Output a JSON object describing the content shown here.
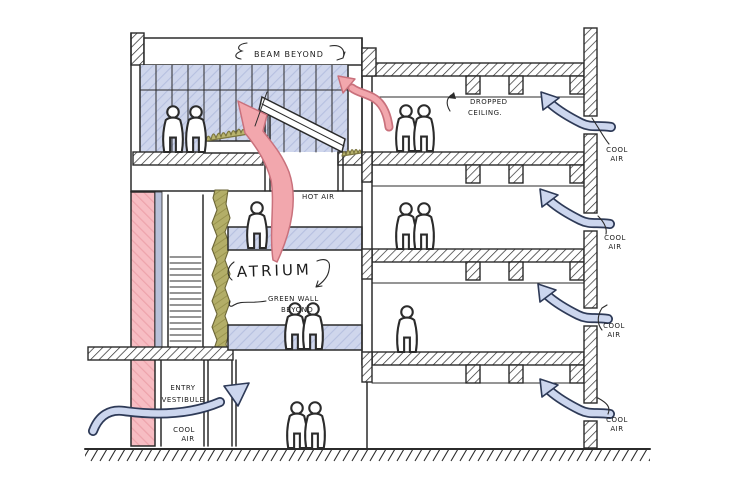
{
  "diagram": {
    "kind": "hand-drawn architectural building section with airflow annotations"
  },
  "labels": {
    "beam_beyond": "BEAM BEYOND",
    "dropped_ceiling": [
      "DROPPED",
      "CEILING."
    ],
    "hot_air": "HOT AIR",
    "atrium": "ATRIUM",
    "green_wall": [
      "GREEN WALL",
      "BEYOND"
    ],
    "entry_vestibule": [
      "ENTRY",
      "VESTIBULE"
    ],
    "cool_air": [
      "COOL",
      "AIR"
    ]
  },
  "colors": {
    "hot_air_arrow": "#f2a7ad",
    "hot_air_outline": "#c9717c",
    "cool_air_arrow": "#ccd6ee",
    "cool_air_outline": "#2e3a57",
    "glazing_blue": "#cfd6ec",
    "structure_pink": "#f7bdc3",
    "green_wall_olive": "#b3ae68",
    "ink": "#2b2b2b",
    "paper": "#ffffff"
  }
}
